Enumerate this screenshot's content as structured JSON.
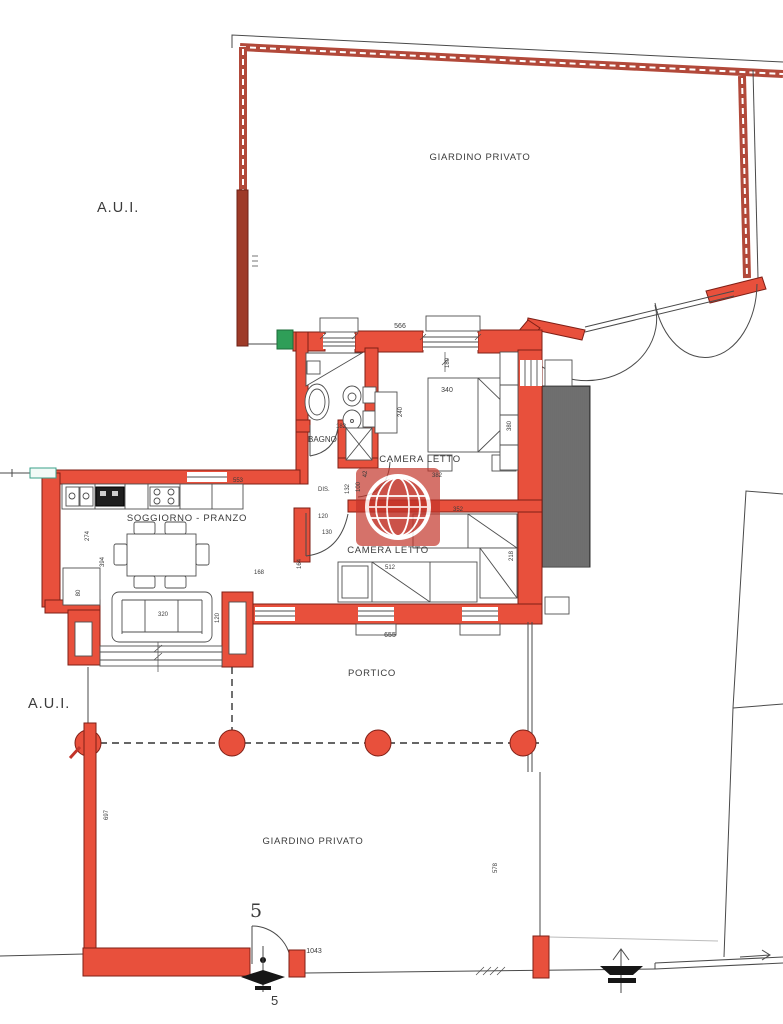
{
  "labels": {
    "aui_top": "A.U.I.",
    "aui_bottom": "A.U.I.",
    "garden_top": "GIARDINO PRIVATO",
    "garden_bottom": "GIARDINO PRIVATO",
    "bathroom": "BAGNO",
    "bedroom1": "CAMERA LETTO",
    "bedroom2": "CAMERA LETTO",
    "living": "SOGGIORNO - PRANZO",
    "portico": "PORTICO",
    "hall": "DIS."
  },
  "dimensions": {
    "top_window": "566",
    "bed1": "340",
    "wardrobe_depth": "240",
    "room1_width": "380",
    "bath_width": "182",
    "window1": "180",
    "room1_length": "382",
    "door_jamb": "42",
    "hall_w1": "132",
    "hall_w2": "100",
    "step1": "120",
    "step2": "130",
    "wall_mid": "352",
    "bed2": "512",
    "room2_side": "218",
    "jamb2": "164",
    "kitchen_wall": "553",
    "living_h1": "274",
    "living_h2": "394",
    "living_w": "168",
    "sofa": "320",
    "sofa_depth": "120",
    "appliance": "80",
    "portico_width": "655",
    "garden_left": "697",
    "garden_front": "1043",
    "garden_right": "578",
    "gate_number": "5",
    "gate_number_repeat": "5"
  },
  "colors": {
    "wall_fill": "#e8503c",
    "wall_outline": "#7e1f16",
    "garden_wall": "#b2493a",
    "dark_wall": "#9e3a28",
    "line": "#4a4a4a",
    "text": "#3b3b3b",
    "green_marker": "#2f9e58",
    "watermark_red": "#c2342a"
  },
  "watermark": {
    "icon": "globe-watermark"
  }
}
